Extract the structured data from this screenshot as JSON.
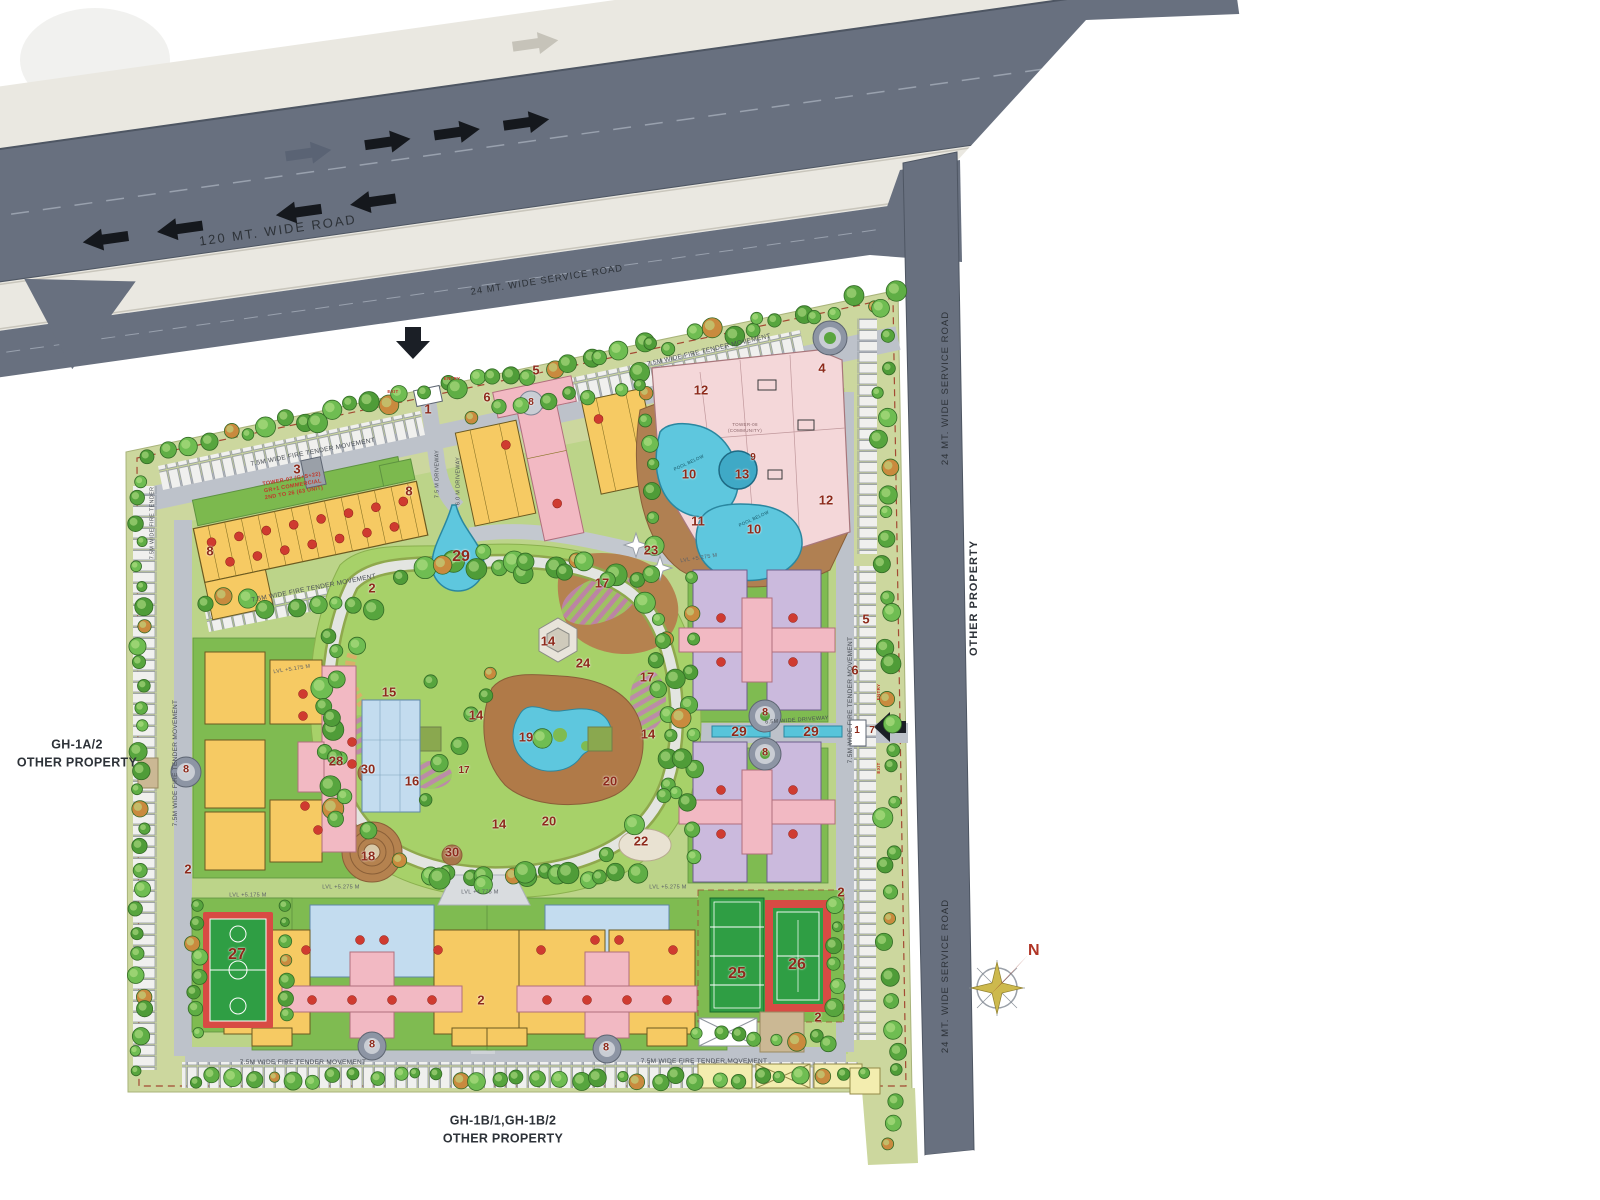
{
  "title": "Residential Township Site Master Plan",
  "palette": {
    "road": "#68707f",
    "median": "#eae8e1",
    "site_border": "#ccd79e",
    "lawn": "#a7d169",
    "plot": "#7fbb51",
    "building_yellow": "#f6ca63",
    "building_pink": "#f2b9c3",
    "building_purple": "#cbbadd",
    "building_blue": "#c3dcef",
    "community_pink": "#f4d7d9",
    "pool": "#5ec7de",
    "deck": "#b08052",
    "court_green": "#2f9e44",
    "court_red": "#d84b44",
    "marker_red": "#8d2a1b"
  },
  "compass": {
    "label": "N"
  },
  "property_labels": {
    "left": "GH-1A/2\nOTHER PROPERTY",
    "bottom": "GH-1B/1,GH-1B/2\nOTHER PROPERTY"
  },
  "labels": [
    {
      "t": "120 MT. WIDE ROAD",
      "x": 278,
      "y": 231,
      "rot": -8,
      "size": 13,
      "color": "#2d3238",
      "ls": 2
    },
    {
      "t": "24 MT. WIDE SERVICE ROAD",
      "x": 547,
      "y": 281,
      "rot": -9,
      "size": 9.5,
      "color": "#2d3238",
      "ls": 1
    },
    {
      "t": "24 MT. WIDE SERVICE ROAD",
      "x": 946,
      "y": 388,
      "rot": -90,
      "size": 9.5,
      "color": "#2d3238",
      "ls": 1
    },
    {
      "t": "OTHER PROPERTY",
      "x": 974,
      "y": 598,
      "rot": -90,
      "size": 11,
      "color": "#2d3238",
      "bold": 1,
      "ls": 1
    },
    {
      "t": "24 MT. WIDE SERVICE ROAD",
      "x": 946,
      "y": 976,
      "rot": -90,
      "size": 9.5,
      "color": "#2d3238",
      "ls": 1
    },
    {
      "t": "7.5M WIDE FIRE TENDER MOVEMENT",
      "x": 709,
      "y": 351,
      "rot": -13,
      "size": 6.5
    },
    {
      "t": "7.5M WIDE FIRE TENDER MOVEMENT",
      "x": 313,
      "y": 453,
      "rot": -11,
      "size": 6.5
    },
    {
      "t": "7.5M WIDE FIRE TENDER MOVEMENT",
      "x": 314,
      "y": 589,
      "rot": -11,
      "size": 6.5
    },
    {
      "t": "7.5M WIDE FIRE TENDER MOVEMENT",
      "x": 176,
      "y": 763,
      "rot": -90,
      "size": 6.5
    },
    {
      "t": "7.5M WIDE FIRE TENDER MOVEMENT",
      "x": 851,
      "y": 700,
      "rot": -90,
      "size": 6.5
    },
    {
      "t": "7.5M WIDE FIRE TENDER MOVEMENT",
      "x": 303,
      "y": 1063,
      "size": 6.5
    },
    {
      "t": "7.5M WIDE FIRE TENDER MOVEMENT",
      "x": 704,
      "y": 1062,
      "size": 6.5
    },
    {
      "t": "7.5M WIDE FIRE TENDER",
      "x": 153,
      "y": 523,
      "rot": -90,
      "size": 5.5
    },
    {
      "t": "7.5 M DRIVEWAY",
      "x": 438,
      "y": 474,
      "rot": -90,
      "size": 5.5
    },
    {
      "t": "6.0 M DRIVEWAY",
      "x": 459,
      "y": 481,
      "rot": -90,
      "size": 5.5
    },
    {
      "t": "6.5M WIDE DRIVEWAY",
      "x": 797,
      "y": 721,
      "rot": -4,
      "size": 5.5
    },
    {
      "t": "LVL +5.175 M",
      "x": 292,
      "y": 670,
      "rot": -9,
      "size": 5.5,
      "color": "#5a5f66"
    },
    {
      "t": "LVL +5.175 M",
      "x": 248,
      "y": 896,
      "size": 5.5,
      "color": "#5a5f66"
    },
    {
      "t": "LVL +5.275 M",
      "x": 341,
      "y": 888,
      "size": 5.5,
      "color": "#5a5f66"
    },
    {
      "t": "LVL +4.775 M",
      "x": 480,
      "y": 893,
      "size": 5.5,
      "color": "#5a5f66"
    },
    {
      "t": "LVL +5.275 M",
      "x": 668,
      "y": 888,
      "size": 5.5,
      "color": "#5a5f66"
    },
    {
      "t": "LVL +5.275 M",
      "x": 699,
      "y": 559,
      "rot": -9,
      "size": 5.5,
      "color": "#5a5f66"
    },
    {
      "t": "POOL BELOW",
      "x": 689,
      "y": 463,
      "rot": -25,
      "size": 4.5,
      "color": "#155363"
    },
    {
      "t": "POOL BELOW",
      "x": 754,
      "y": 519,
      "rot": -25,
      "size": 4.5,
      "color": "#155363"
    },
    {
      "t": "TOWER-07 (G+S+22)\nGR+1 COMMERCIAL\n2ND TO 26 (63 UNIT)",
      "x": 293,
      "y": 487,
      "rot": -10,
      "size": 5.5,
      "color": "#c0392b",
      "bold": 1
    },
    {
      "t": "TOWER-08\n(COMMUNITY)",
      "x": 745,
      "y": 428,
      "size": 4.5,
      "color": "#8a6468"
    },
    {
      "t": "ENTRY",
      "x": 452,
      "y": 379,
      "size": 4.5,
      "color": "#c0392b",
      "bold": 1
    },
    {
      "t": "EXIT",
      "x": 393,
      "y": 392,
      "size": 4.5,
      "color": "#c0392b",
      "bold": 1
    },
    {
      "t": "ENTRY",
      "x": 879,
      "y": 692,
      "rot": -90,
      "size": 4.5,
      "color": "#c0392b",
      "bold": 1
    },
    {
      "t": "EXIT",
      "x": 879,
      "y": 768,
      "rot": -90,
      "size": 4.5,
      "color": "#c0392b",
      "bold": 1
    }
  ],
  "markers": [
    {
      "t": "1",
      "x": 428,
      "y": 409
    },
    {
      "t": "3",
      "x": 297,
      "y": 469
    },
    {
      "t": "8",
      "x": 210,
      "y": 551
    },
    {
      "t": "8",
      "x": 409,
      "y": 491
    },
    {
      "t": "2",
      "x": 372,
      "y": 588
    },
    {
      "t": "5",
      "x": 536,
      "y": 370
    },
    {
      "t": "6",
      "x": 487,
      "y": 397
    },
    {
      "t": "8",
      "x": 531,
      "y": 403,
      "s": 10
    },
    {
      "t": "4",
      "x": 822,
      "y": 368
    },
    {
      "t": "12",
      "x": 701,
      "y": 390
    },
    {
      "t": "12",
      "x": 826,
      "y": 500
    },
    {
      "t": "9",
      "x": 753,
      "y": 458,
      "s": 10
    },
    {
      "t": "13",
      "x": 742,
      "y": 474
    },
    {
      "t": "10",
      "x": 689,
      "y": 474
    },
    {
      "t": "10",
      "x": 754,
      "y": 529
    },
    {
      "t": "11",
      "x": 698,
      "y": 521
    },
    {
      "t": "23",
      "x": 651,
      "y": 550
    },
    {
      "t": "29",
      "x": 461,
      "y": 557,
      "s": 16
    },
    {
      "t": "17",
      "x": 602,
      "y": 583
    },
    {
      "t": "24",
      "x": 583,
      "y": 663
    },
    {
      "t": "14",
      "x": 548,
      "y": 641
    },
    {
      "t": "15",
      "x": 389,
      "y": 692
    },
    {
      "t": "14",
      "x": 476,
      "y": 715
    },
    {
      "t": "19",
      "x": 526,
      "y": 737
    },
    {
      "t": "17",
      "x": 647,
      "y": 677
    },
    {
      "t": "14",
      "x": 648,
      "y": 734
    },
    {
      "t": "28",
      "x": 336,
      "y": 761
    },
    {
      "t": "30",
      "x": 368,
      "y": 769
    },
    {
      "t": "16",
      "x": 412,
      "y": 781
    },
    {
      "t": "17",
      "x": 464,
      "y": 771,
      "s": 10
    },
    {
      "t": "20",
      "x": 610,
      "y": 781
    },
    {
      "t": "20",
      "x": 549,
      "y": 821
    },
    {
      "t": "14",
      "x": 499,
      "y": 824
    },
    {
      "t": "22",
      "x": 641,
      "y": 841
    },
    {
      "t": "18",
      "x": 368,
      "y": 856
    },
    {
      "t": "30",
      "x": 452,
      "y": 852
    },
    {
      "t": "5",
      "x": 866,
      "y": 619
    },
    {
      "t": "6",
      "x": 855,
      "y": 670
    },
    {
      "t": "8",
      "x": 765,
      "y": 713,
      "s": 11
    },
    {
      "t": "8",
      "x": 765,
      "y": 753,
      "s": 11
    },
    {
      "t": "29",
      "x": 739,
      "y": 731,
      "s": 14
    },
    {
      "t": "29",
      "x": 811,
      "y": 731,
      "s": 14
    },
    {
      "t": "1",
      "x": 857,
      "y": 731,
      "s": 10
    },
    {
      "t": "7",
      "x": 872,
      "y": 731,
      "s": 10
    },
    {
      "t": "8",
      "x": 186,
      "y": 770,
      "s": 11
    },
    {
      "t": "2",
      "x": 188,
      "y": 869
    },
    {
      "t": "27",
      "x": 237,
      "y": 955,
      "s": 16
    },
    {
      "t": "8",
      "x": 372,
      "y": 1045,
      "s": 11
    },
    {
      "t": "2",
      "x": 481,
      "y": 1000
    },
    {
      "t": "8",
      "x": 606,
      "y": 1048,
      "s": 11
    },
    {
      "t": "25",
      "x": 737,
      "y": 974,
      "s": 16
    },
    {
      "t": "26",
      "x": 797,
      "y": 965,
      "s": 16
    },
    {
      "t": "2",
      "x": 841,
      "y": 892
    },
    {
      "t": "2",
      "x": 818,
      "y": 1017
    }
  ]
}
